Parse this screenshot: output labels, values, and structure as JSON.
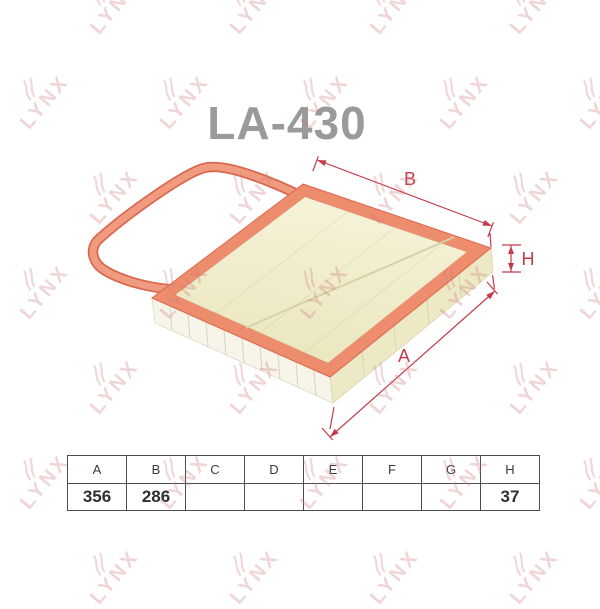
{
  "title": "LA-430",
  "watermark": {
    "text": "LYNX"
  },
  "diagram": {
    "type": "panel-air-filter-dimensional-drawing",
    "labels": {
      "a": "A",
      "b": "B",
      "h": "H"
    },
    "colors": {
      "gasket": "#ee8c6e",
      "gasket_edge": "#d9674e",
      "media": "#f1eecb",
      "dimension": "#c43c4a",
      "title": "#9a9a9a",
      "watermark": "#e8c4c4"
    }
  },
  "table": {
    "headers": [
      "A",
      "B",
      "C",
      "D",
      "E",
      "F",
      "G",
      "H"
    ],
    "values": [
      "356",
      "286",
      "",
      "",
      "",
      "",
      "",
      "37"
    ]
  }
}
